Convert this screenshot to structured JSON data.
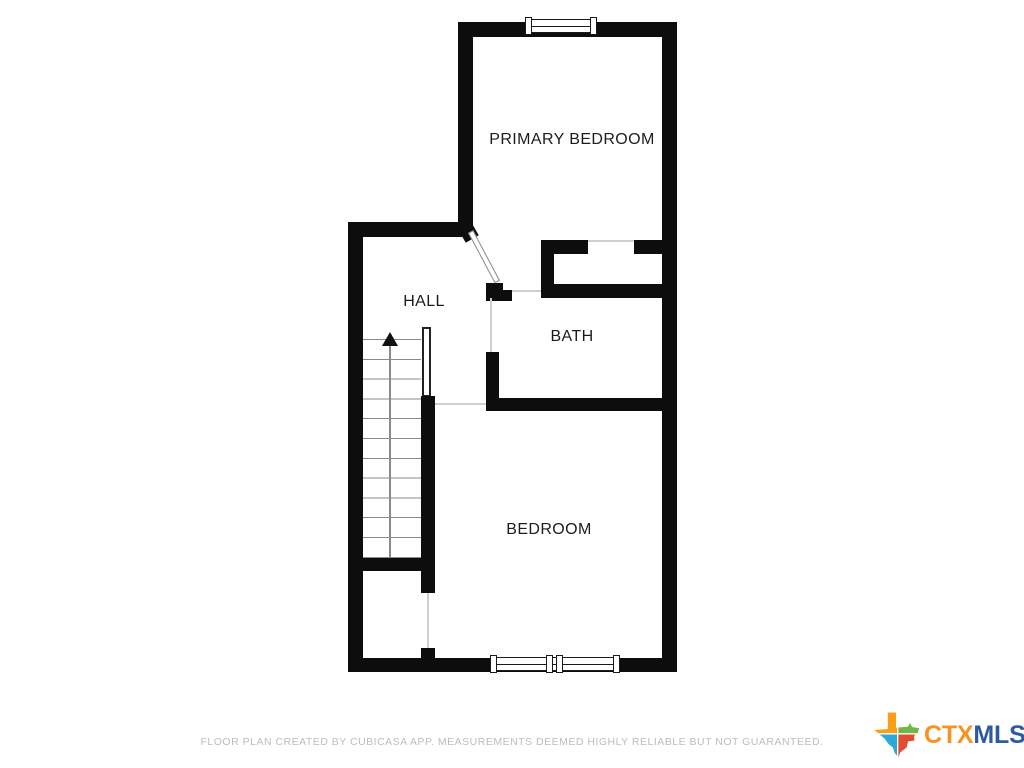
{
  "floor_plan": {
    "rooms": [
      {
        "name": "primary-bedroom",
        "label": "PRIMARY BEDROOM"
      },
      {
        "name": "hall",
        "label": "HALL"
      },
      {
        "name": "bath",
        "label": "BATH"
      },
      {
        "name": "bedroom",
        "label": "BEDROOM"
      }
    ],
    "stairs": {
      "direction": "up",
      "step_count": 12
    },
    "features": [
      "top-window",
      "bottom-double-window",
      "stair-railing",
      "swing-door",
      "closet-openings"
    ],
    "colors": {
      "wall": "#0d0d0d",
      "background": "#ffffff",
      "opening_line": "#cfcfcf",
      "step_line": "#8a8a8a"
    }
  },
  "footer": {
    "disclaimer": "FLOOR PLAN CREATED BY CUBICASA APP. MEASUREMENTS DEEMED HIGHLY RELIABLE BUT NOT GUARANTEED.",
    "text_color": "#bdbdbd"
  },
  "branding": {
    "logo_text_1": "CTX",
    "logo_text_2": "MLS",
    "icon": "texas-state-icon",
    "colors": {
      "ctx_orange": "#F7941D",
      "mls_blue": "#2F5B9E",
      "texas_orange": "#F6A01A",
      "texas_green": "#6FB844",
      "texas_teal": "#2BA9D6",
      "texas_red": "#E04C34"
    }
  }
}
